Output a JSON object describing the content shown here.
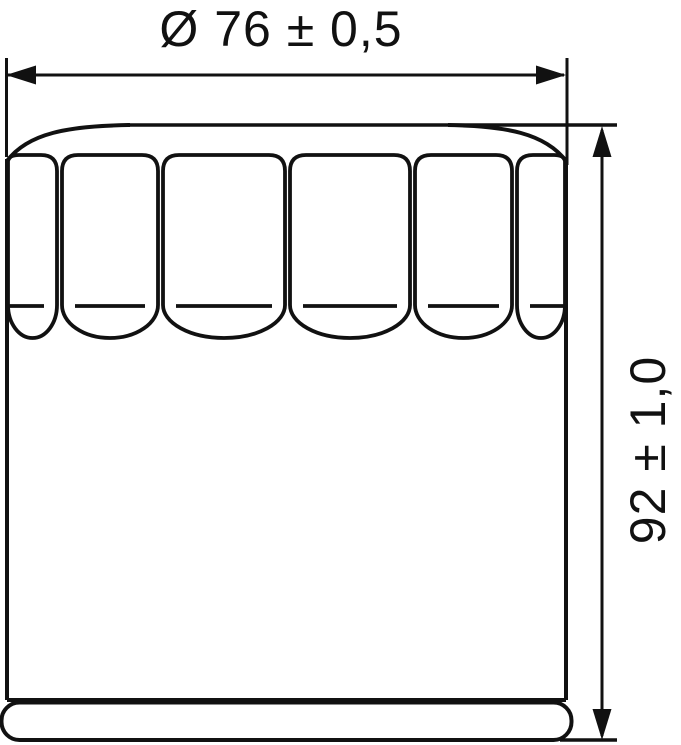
{
  "page": {
    "background": "#ffffff"
  },
  "drawing": {
    "subject": "oil-filter-side-view-technical-drawing",
    "stroke_color": "#111111",
    "flute_count": 6,
    "labels": {
      "diameter": "Ø 76 ± 0,5",
      "height": "92 ± 1,0"
    }
  }
}
